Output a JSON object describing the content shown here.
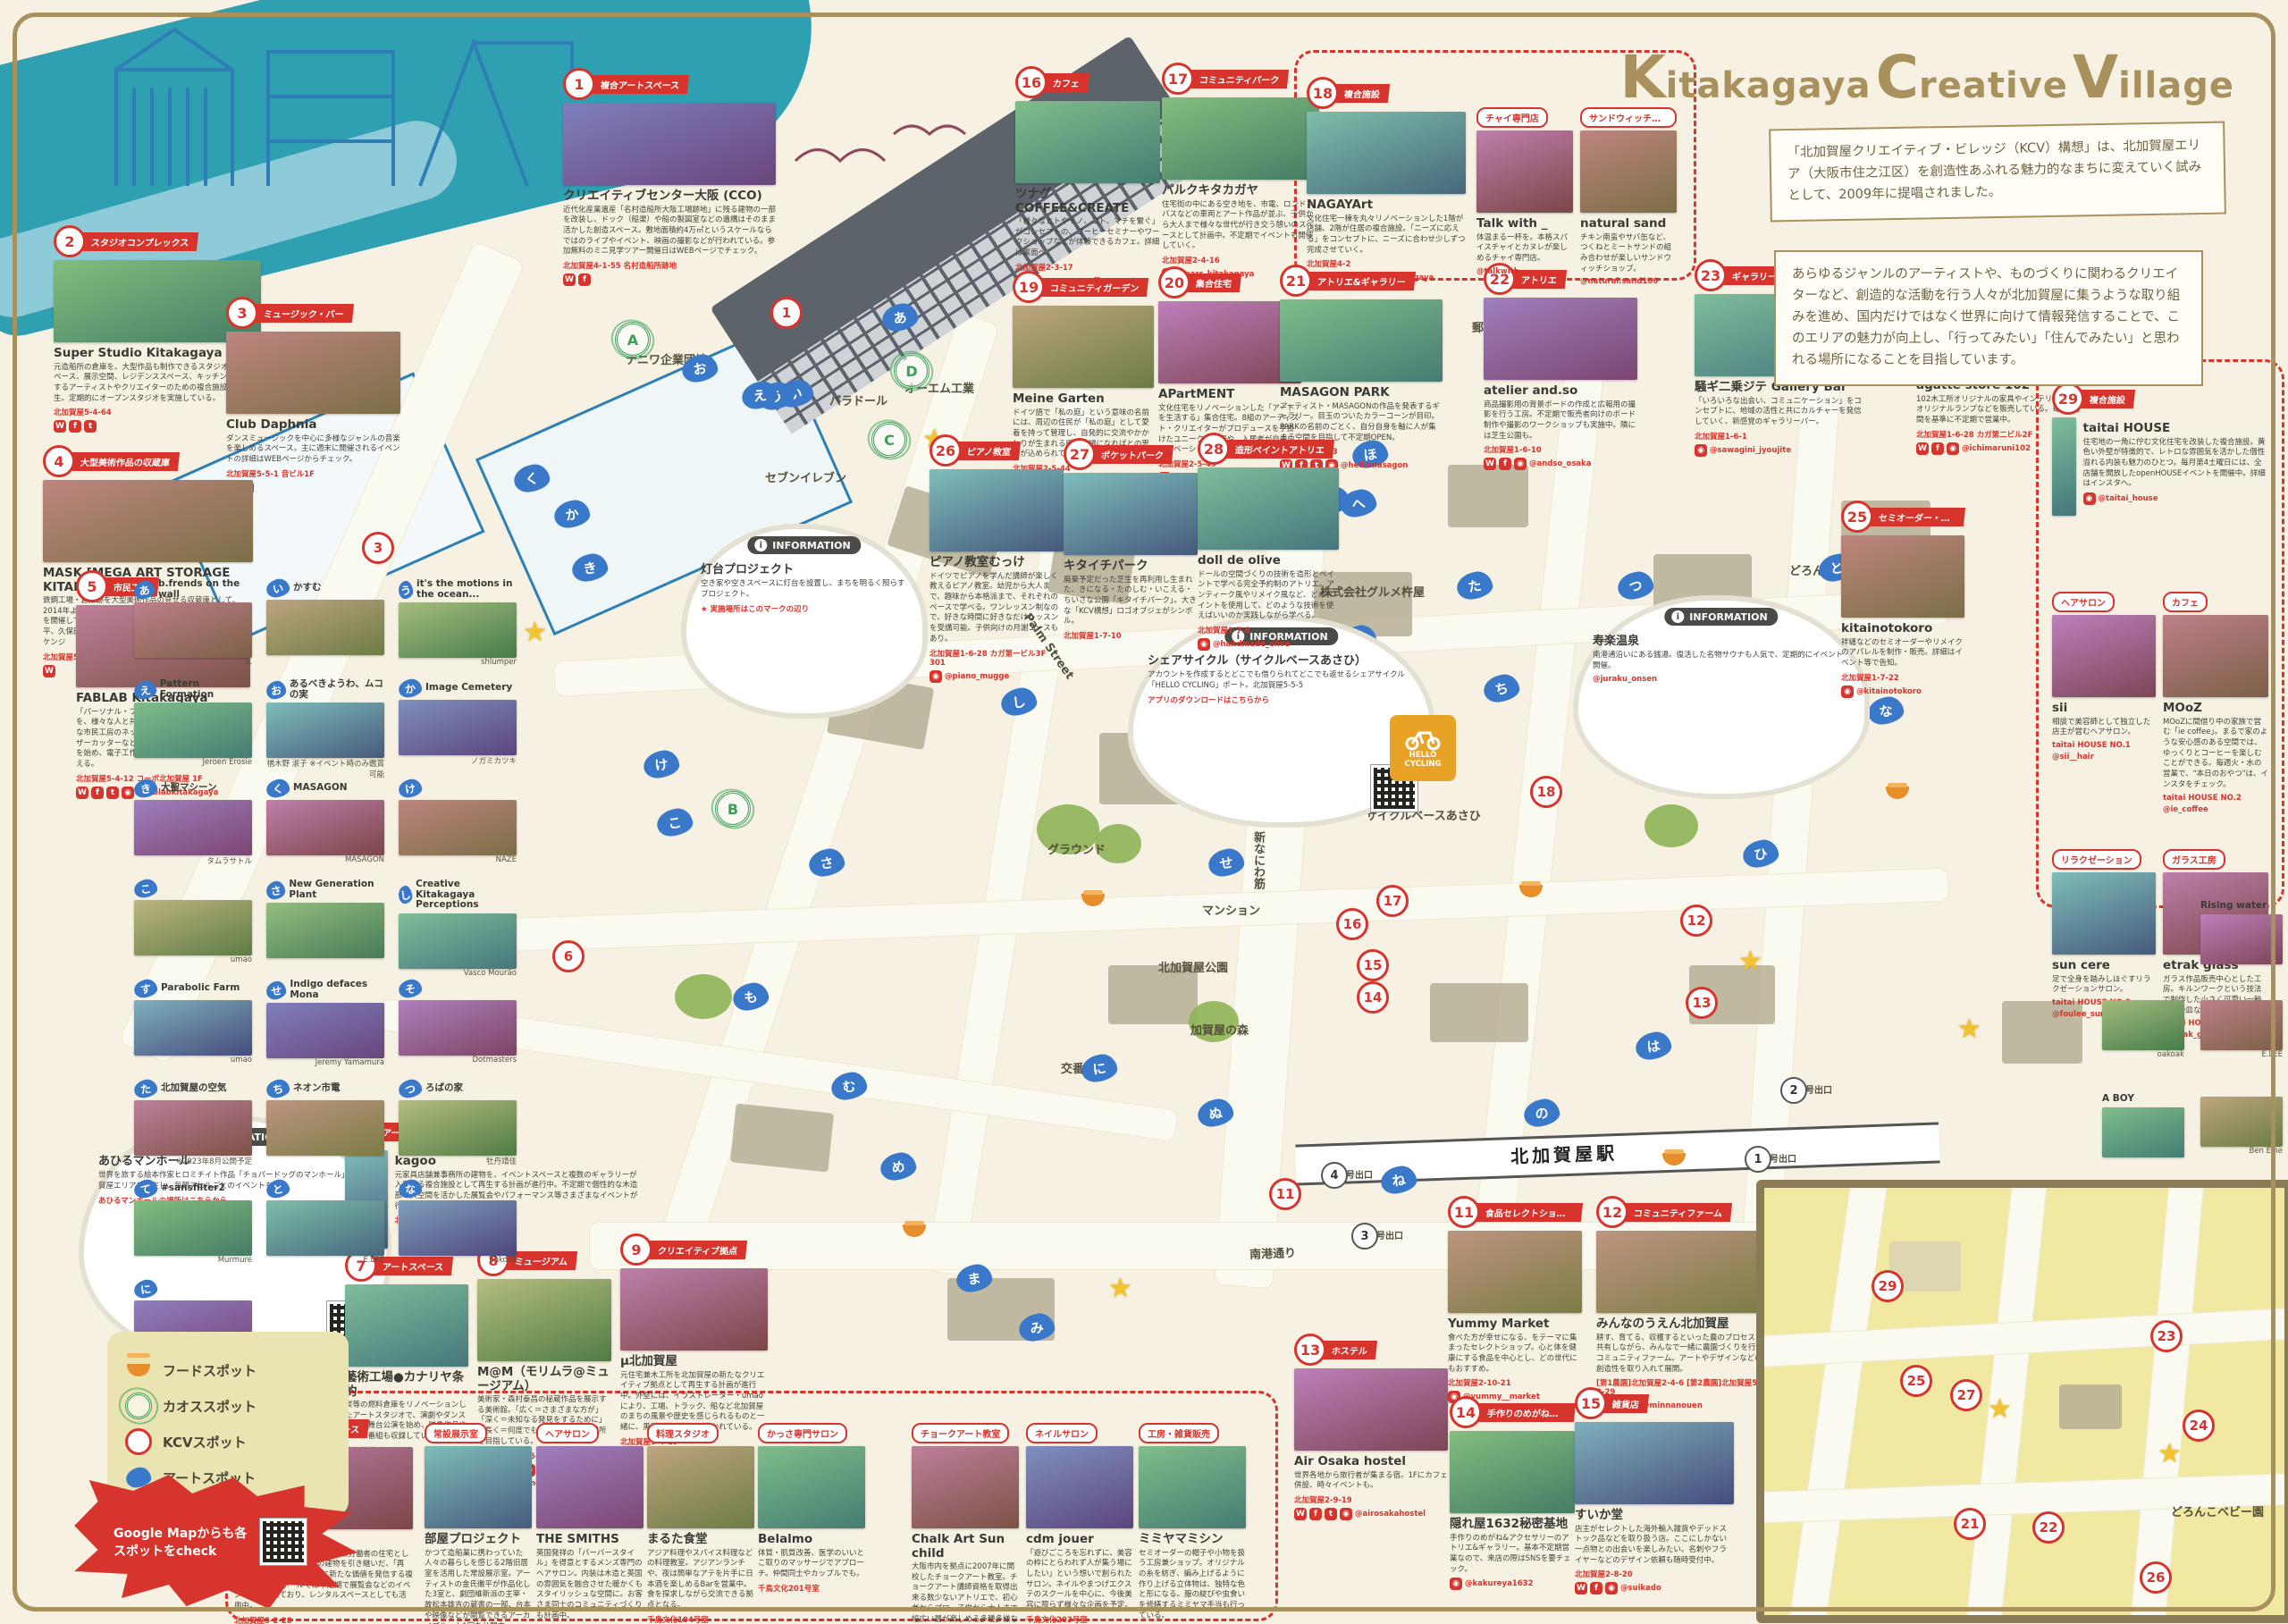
{
  "brand": {
    "line": "Kitakagaya Creative Village",
    "k": "K",
    "itakagaya": "itakagaya",
    "c": "C",
    "reative": "reative",
    "v": "V",
    "illage": "illage"
  },
  "intro": {
    "box1": "「北加賀屋クリエイティブ・ビレッジ（KCV）構想」は、北加賀屋エリア（大阪市住之江区）を創造性あふれる魅力的なまちに変えていく試みとして、2009年に提唱されました。",
    "box2": "あらゆるジャンルのアーティストや、ものづくりに関わるクリエイターなど、創造的な活動を行う人々が北加賀屋に集うような取り組みを進め、国内だけではなく世界に向けて情報発信することで、このエリアの魅力が向上し、「行ってみたい」「住んでみたい」と思われる場所になることを目指しています。"
  },
  "legend": {
    "items": [
      {
        "icon": "food-bowl-icon",
        "label": "フードスポット"
      },
      {
        "icon": "chaos-spot-icon",
        "label": "カオススポット"
      },
      {
        "icon": "kcv-spot-icon",
        "label": "KCVスポット"
      },
      {
        "icon": "art-spot-icon",
        "label": "アートスポット"
      }
    ]
  },
  "google_map_note": "Google Mapからも各スポットをcheck",
  "info_header": "INFORMATION",
  "hello_cycling": "HELLO CYCLING",
  "station": "北加賀屋駅",
  "pois": [
    {
      "num": 1,
      "cat": "複合アートスペース",
      "name": "クリエイティブセンター大阪 (CCO)",
      "desc": "近代化産業遺産「名村造船所大阪工場跡地」に残る建物の一部を改装し、ドック（船渠）や船の製図室などの遺構はそのまま活かした創造スペース。敷地面積約4万㎡というスケールならではのライブやイベント、映画の撮影などが行われている。参加無料のミニ見学ツアー開催日はWEBページでチェック。",
      "addr": "北加賀屋4-1-55 名村造船所跡地",
      "handle": "",
      "sns": [
        "W",
        "f"
      ]
    },
    {
      "num": 2,
      "cat": "スタジオコンプレックス",
      "name": "Super Studio Kitakagaya",
      "desc": "元造船所の倉庫を、大型作品も制作できるスタジオ、ラボスペース、展示空間、レジデンススペース、キッチンなどを有するアーティストやクリエイターのための複合施設として再生。定期的にオープンスタジオを実施している。",
      "addr": "北加賀屋5-4-64",
      "handle": "",
      "sns": [
        "W",
        "f",
        "t"
      ]
    },
    {
      "num": 3,
      "cat": "ミュージック・バー",
      "name": "Club Daphnia",
      "desc": "ダンスミュージックを中心に多様なジャンルの音楽を楽しめるスペース。主に週末に開催されるイベントの詳細はWEBページからチェック。",
      "addr": "北加賀屋5-5-1 音ビル1F",
      "handle": "",
      "sns": [
        "W",
        "t"
      ]
    },
    {
      "num": 4,
      "cat": "大型美術作品の収蔵庫",
      "name": "MASK [MEGA ART STORAGE KITAKAGAYA]",
      "desc": "鉄鋼工場・倉庫跡を大型美術作品の見せる収蔵庫として、2014年より年に1回、一般公開する展覧会「Open Storage」を開催している。参加作家（五十音順）：宇治野宗輝、金氏徹平、久保田弘成、名和晃平、持田敦子、やなぎみわ、ヤノベケンジ",
      "addr": "北加賀屋5-4-48",
      "handle": "",
      "sns": [
        "W"
      ]
    },
    {
      "num": 5,
      "cat": "市民工房",
      "name": "FABLAB Kitakagaya",
      "desc": "「パーソナル・ファブリケーション」の可能性を、様々な人と共同で開拓していくための実験的な市民工房のネットワーク。3Dプリンターやレーザーカッターなどのデジタルファブリケーションを始め、電子工作用機材、木工用の工作機械を備える。",
      "addr": "北加賀屋5-4-12 コーポ北加賀屋 1F",
      "handle": "@fablabkitakagaya",
      "sns": [
        "W",
        "f",
        "t",
        "o"
      ]
    },
    {
      "num": 6,
      "cat": "アートスペース",
      "name": "kagoo",
      "desc": "元家具店舗兼事務所の建物を、イベントスペースと複数のギャラリーが入居する複合施設として再生する計画が進行中。不定期で個性的な木造部の大空間を活かした展覧会やパフォーマンス等さまざまなイベントが行われている。",
      "addr": "北加賀屋5-4-19",
      "handle": "",
      "sns": []
    },
    {
      "num": 7,
      "cat": "アートスペース",
      "name": "藝術工場●カナリヤ条約",
      "desc": "炭等の燃料倉庫をリノベーションしたアートスタジオで、演劇やダンスなどの舞台公演を始め、映像作品やテレビ番組も収録している。",
      "addr": "北加賀屋5-5-35",
      "handle": "",
      "sns": [
        "W",
        "t"
      ]
    },
    {
      "num": 8,
      "cat": "ミュージアム",
      "name": "M@M（モリムラ@ミュージアム）",
      "desc": "美術家・森村泰昌の秘蔵作品を展示する美術館。「広く＝さまざまな方が」「深く＝未知なる発見をするために」「長く＝何度でも訪れたくなる」場所を目指している。",
      "addr": "北加賀屋5-5-36-2F",
      "handle": "@yasumasamorimura",
      "sns": [
        "W",
        "f",
        "t",
        "o"
      ]
    },
    {
      "num": 9,
      "cat": "クリエイティブ拠点",
      "name": "μ北加賀屋",
      "desc": "元住宅兼木工所を北加賀屋の新たなクリエイティブ拠点として再生する計画が進行中。外壁には、イラストレーター・umaoにより、工場、トラック、船など北加賀屋のまちの風景や歴史を感じられるものと一緒に、黒猫が遊ぶ様子が描かれている。",
      "addr": "北加賀屋5-4-19",
      "handle": "",
      "sns": []
    },
    {
      "num": 10,
      "cat": "コミュニティスペース",
      "name": "千鳥文化",
      "desc": "造船業が盛んだった頃に、店舗兼労働者の住宅として使われていた文化住宅の建物を引き継いだ、「再生」「循環」をキーワードに新たな価値を発信する複合施設。1Fのホールでは不定期で展覧会などのイベントが行われており、レンタルスペースとしても活用中。",
      "addr": "北加賀屋5-2-28",
      "handle": "@chidoribunka",
      "sns": [
        "W",
        "f",
        "o"
      ]
    },
    {
      "num": 11,
      "cat": "食品セレクトショップ",
      "name": "Yummy Market",
      "desc": "食べた方が幸せになる、をテーマに集まったセレクトショップ。心と体を健康にする食品を中心とし、どの世代にもおすすめ。",
      "addr": "北加賀屋2-10-21",
      "handle": "@yummy__market",
      "sns": [
        "o"
      ]
    },
    {
      "num": 12,
      "cat": "コミュニティファーム",
      "name": "みんなのうえん北加賀屋",
      "desc": "耕す、育てる、収穫するといった農のプロセスを共有しながら、みんなで一緒に農園づくりを行うコミュニティファーム。アートやデザインなどの創造性を取り入れて展開。",
      "addr": "[第1農園]北加賀屋2-4-6 [第2農園]北加賀屋5-2-29",
      "handle": "@minnanouen",
      "sns": [
        "W",
        "f",
        "o"
      ]
    },
    {
      "num": 13,
      "cat": "ホステル",
      "name": "Air Osaka hostel",
      "desc": "世界各地から旅行者が集まる宿。1Fにカフェ併設、時々イベントも。",
      "addr": "北加賀屋2-9-19",
      "handle": "@airosakahostel",
      "sns": [
        "W",
        "f",
        "t",
        "o"
      ]
    },
    {
      "num": 14,
      "cat": "手作りのめがね&アクセサリー",
      "name": "隠れ屋1632秘密基地",
      "desc": "手作りのめがね&アクセサリーのアトリエ&ギャラリー。基本不定期営業なので、来店の際はSNSを要チェック。",
      "addr": "",
      "handle": "@kakureya1632",
      "sns": [
        "o"
      ]
    },
    {
      "num": 15,
      "cat": "雑貨店",
      "name": "すいか堂",
      "desc": "店主がセレクトした海外輸入雑貨やデッドストック品などを取り扱う店。ここにしかない一点物との出会いを楽しみたい。名刺やフライヤーなどのデザイン依頼も随時受付中。",
      "addr": "北加賀屋2-8-20",
      "handle": "@suikado",
      "sns": [
        "W",
        "f",
        "o"
      ]
    },
    {
      "num": 16,
      "cat": "カフェ",
      "name": "ツナグ COFFEE&CREATE",
      "desc": "「様々なヒトやモノ、コト、マチを繋ぐ」がコンセプトの、コーヒーセミナーやワークショップなどが体験できるカフェ。詳細は裏面へ。",
      "addr": "北加賀屋2-3-17",
      "handle": "@tsu_na_gu.coffee_create",
      "sns": [
        "o"
      ]
    },
    {
      "num": 17,
      "cat": "コミュニティパーク",
      "name": "パルクキタカガヤ",
      "desc": "住宅街の中にある空き地を、市電、ロンドンバスなどの車両とアート作品が並ぶ、子供から大人まで様々な世代が行き交う憩いのスペースとして計画中。不定期でイベントも開催していく。",
      "addr": "北加賀屋2-4-16",
      "handle": "@parc_kitakagaya",
      "sns": [
        "o"
      ]
    },
    {
      "num": 18,
      "cat": "複合施設",
      "name": "NAGAYArt",
      "desc": "文化住宅一棟を丸々リノベーションした1階が店舗、2階が住居の複合施設。「ニーズに応える」をコンセプトに、ニーズに合わせ少しずつ完成させていく。",
      "addr": "北加賀屋4-2",
      "handle": "@nagayart_kitakagaya",
      "sns": [
        "f",
        "o"
      ]
    },
    {
      "num": 19,
      "cat": "コミュニティガーデン",
      "name": "Meine Garten",
      "desc": "ドイツ語で「私の庭」という意味の名前には、周辺の住民が「私の庭」として愛着を持って管理し、自発的に交流やかかわりが生まれる暖かい場になればとの思いが込められている。",
      "addr": "北加賀屋2-5-44",
      "handle": "",
      "sns": []
    },
    {
      "num": 20,
      "cat": "集合住宅",
      "name": "APartMENT",
      "desc": "文化住宅をリノベーションした「アートを生活する」集合住宅。8組のアーティスト・クリエイターがプロデュースを手掛けたユニークな部屋や、入居者が自由にリノベーションできる部屋がある。",
      "addr": "北加賀屋2-5-45",
      "handle": "",
      "sns": [
        "W"
      ]
    },
    {
      "num": 21,
      "cat": "アトリエ&ギャラリー",
      "name": "MASAGON PARK",
      "desc": "アーティスト・MASAGONの作品を発表するギャラリー。目玉のついたカラーコーンが目印。PARKの名前のごとく、自分自身を軸に人が集まる空間を目指して不定期OPEN。",
      "addr": "北加賀屋1-6-23",
      "handle": "@hellomasagon",
      "sns": [
        "W",
        "f",
        "t",
        "o"
      ]
    },
    {
      "num": 22,
      "cat": "アトリエ",
      "name": "atelier and.so",
      "desc": "商品撮影用の背景ボードの作成と広報用の撮影を行う工房。不定期で販売者向けのボード制作や撮影のワークショップも実施中。隣には芝生公園も。",
      "addr": "北加賀屋1-6-10",
      "handle": "@andso_osaka",
      "sns": [
        "W",
        "f",
        "o"
      ]
    },
    {
      "num": 23,
      "cat": "ギャラリー・バー",
      "name": "騒ギ二乗ジテ Gallery Bar",
      "desc": "「いろいろな出会い、コミュニケーション」をコンセプトに、地域の活性と共にカルチャーを発信していく、新感覚のギャラリーバー。",
      "addr": "北加賀屋1-6-1",
      "handle": "@sawagini_jyoujite",
      "sns": [
        "o"
      ]
    },
    {
      "num": 24,
      "cat": "オリジナル家具・雑貨ショップ",
      "name": "agatte store 102",
      "desc": "102木工所オリジナルの家具やインテリア小物、オリジナルランプなどを販売している。毎月1週間を基準に不定期で営業中。",
      "addr": "北加賀屋1-6-28 カガ第二ビル2F",
      "handle": "@ichimaruni102",
      "sns": [
        "W",
        "f",
        "o"
      ]
    },
    {
      "num": 25,
      "cat": "セミオーダー・リメイク・アパレル",
      "name": "kitainotokoro",
      "desc": "袢纏などのセミオーダーやリメイクのアパレルを制作・販売。詳細はイベント等で告知。",
      "addr": "北加賀屋1-7-22",
      "handle": "@kitainotokoro",
      "sns": [
        "o"
      ]
    },
    {
      "num": 26,
      "cat": "ピアノ教室",
      "name": "ピアノ教室むっけ",
      "desc": "ドイツでピアノを学んだ講師が楽しく教えるピアノ教室。幼児から大人まで、趣味から本格派まで、それぞれのペースで学べる。ワンレッスン制なので、好きな時間に好きなだけレッスンを受講可能。子供向けの月謝コースもあり。",
      "addr": "北加賀屋1-6-28 カガ第一ビル3F 301",
      "handle": "@piano_mugge",
      "sns": [
        "o"
      ]
    },
    {
      "num": 27,
      "cat": "ポケットパーク",
      "name": "キタイチパーク",
      "desc": "廃棄予定だった芝生を再利用し生まれた、きになる・たのしむ・いこえる・ちいさな公園「キタイチパーク」。大きな「KCV構想」ロゴオブジェがシンボル。",
      "addr": "北加賀屋1-7-10",
      "handle": "",
      "sns": []
    },
    {
      "num": 28,
      "cat": "造形ペイントアトリエ",
      "name": "doll de olive",
      "desc": "ドールの空間づくりの技術を造形とペイントで学べる完全予約制のアトリエ。アンティーク風やリメイク風など、どのペイントを使用して、どのような技術を使えばいいのか実践しながら学べる。",
      "addr": "北加賀屋1-7-8",
      "handle": "@handmade_olive",
      "sns": [
        "o"
      ]
    },
    {
      "num": 29,
      "cat": "複合施設",
      "name": "taitai HOUSE",
      "desc": "住宅地の一角に佇む文化住宅を改装した複合施設。黄色い外壁が特徴的で、レトロな雰囲気を活かした個性溢れる内装も魅力のひとつ。毎月第4土曜日には、全店舗を開放したopenHOUSEイベントを開催中。詳細はインスタへ。",
      "addr": "",
      "handle": "@taitai_house",
      "sns": [
        "o"
      ]
    }
  ],
  "nagayart_tenants": [
    {
      "cat": "チャイ専門店",
      "name": "Talk with _",
      "desc": "体温まる一杯を。本格スパイスチャイとカヌレが楽しめるチャイ専門店。",
      "addr": "",
      "handle": "@talkwith__"
    },
    {
      "cat": "サンドウィッチ専門店",
      "name": "natural sand",
      "desc": "チキン南蛮やサバ缶など、つくねとミートサンドの組み合わせが楽しいサンドウィッチショップ。",
      "addr": "",
      "handle": "@natural.sand106"
    }
  ],
  "taitai_tenants": [
    {
      "cat": "ヘアサロン",
      "name": "sii",
      "desc": "相談で美容師として独立した店主が営むヘアサロン。",
      "addr": "taitai HOUSE NO.1",
      "handle": "@sii__hair"
    },
    {
      "cat": "カフェ",
      "name": "MOoZ",
      "desc": "MOoZに間借り中の家族で営む「ie coffee」。まるで家のような安心感のある空間では、ゆっくりとコーヒーを楽しむことができる。毎週火・水の営業で、\"本日のおやつ\"は、インスタをチェック。",
      "addr": "taitai HOUSE NO.2",
      "handle": "@ie_coffee"
    },
    {
      "cat": "リラクゼーション",
      "name": "sun cere",
      "desc": "足で全身を踏みしほぐすリラクゼーションサロン。",
      "addr": "taitai HOUSE NO.3",
      "handle": "@foulee_suncere"
    },
    {
      "cat": "ガラス工房",
      "name": "etrak glass",
      "desc": "ガラス作品販売中心とした工房。キルンワークという技法で制作した小さく可愛い一輪挿しや皿など。",
      "addr": "taitai HOUSE NO.4",
      "handle": "@etrak_glass"
    }
  ],
  "chidori_tenants": [
    {
      "cat": "常設展示室",
      "name": "部屋プロジェクト",
      "desc": "かつて造船業に携わっていた人々の暮らしを感じる2階旧居室を活用した常設展示室。アーティストの金氏徹平が作品化した3室と、劇団維新派の主宰・故松本雄吉の蔵書の一部、台本や映像などが閲覧できるアーカイブルーム1室を公開中。",
      "addr": "千鳥文化2F",
      "handle": ""
    },
    {
      "cat": "ヘアサロン",
      "name": "THE SMITHS",
      "desc": "英国発祥の「バーバースタイル」を得意とするメンズ専門のヘアサロン。内装は木造と英国の雰囲気を融合させた暖かくもスタイリッシュな空間に。お客さま同士のコミュニティづくりも計画中。",
      "addr": "千鳥文化103号室",
      "handle": "@thesmiths_barber"
    },
    {
      "cat": "料理スタジオ",
      "name": "まるた食堂",
      "desc": "アジア料理やスパイス料理などの料理教室。アジアンランチや、夜は簡単なアテを片手に日本酒を楽しめるBarを営業中。食を探求しながら交流できる拠点となる。",
      "addr": "千鳥文化104号室",
      "handle": "@maruta_shokudo"
    },
    {
      "cat": "かっさ専門サロン",
      "name": "Belalmo",
      "desc": "体質・肌質改善、医学のいいとこ取りのマッサージでアプローチ。仲間同士やカップルでも。",
      "addr": "千鳥文化201号室",
      "handle": ""
    },
    {
      "cat": "チョークアート教室",
      "name": "Chalk Art Sun child",
      "desc": "大阪市内を拠点に2007年に開校したチョークアート教室。チョークアート講師資格を取得出来る数少ないアトリエで、初心者からプロ、子供から大人まで幅広い層が楽しめる多種多様なコースとレッスンが用意されている。",
      "addr": "千鳥文化202号室",
      "handle": "@chalkartsunchild"
    },
    {
      "cat": "ネイルサロン",
      "name": "cdm jouer",
      "desc": "「遊びごころを忘れずに、美容の枠にとらわれず人が集う場にしたい」という想いで創られたサロン。ネイルやまつげエクステのスクールを中心に、今後美容に限らず様々な企画を予定。",
      "addr": "千鳥文化203号室",
      "handle": "@nailschool.cdm"
    },
    {
      "cat": "工房・雑貨販売",
      "name": "ミミヤマミシン",
      "desc": "セミオーダーの帽子や小物を扱う工房兼ショップ。オリジナルの糸を紡ぎ、編み上げるように作り上げる立体物は、独特な色と形になる。服の綻びや虫食いを修繕するミミヤマ手当も行っている。",
      "addr": "千鳥文化205号室",
      "handle": "@soda_tomoko"
    }
  ],
  "art_spots": [
    {
      "kana": "あ",
      "name": "b.frends on the wall",
      "artist": "b."
    },
    {
      "kana": "い",
      "name": "かすむ",
      "artist": ""
    },
    {
      "kana": "う",
      "name": "it's the motions in the ocean...",
      "artist": "shlumper"
    },
    {
      "kana": "え",
      "name": "Pattern Formation",
      "artist": "Jeroen Erosie"
    },
    {
      "kana": "お",
      "name": "あるべきようわ、ムコの実",
      "artist": "楢木野 淑子 ※イベント時のみ鑑賞可能"
    },
    {
      "kana": "か",
      "name": "Image Cemetery",
      "artist": "ノガミカツキ"
    },
    {
      "kana": "き",
      "name": "大聖マシーン",
      "artist": "タムラサトル"
    },
    {
      "kana": "く",
      "name": "MASAGON",
      "artist": "MASAGON"
    },
    {
      "kana": "け",
      "name": "",
      "artist": "NAZE"
    },
    {
      "kana": "こ",
      "name": "",
      "artist": "umao"
    },
    {
      "kana": "さ",
      "name": "New Generation Plant",
      "artist": ""
    },
    {
      "kana": "し",
      "name": "Creative Kitakagaya Perceptions",
      "artist": "Vasco Mourão"
    },
    {
      "kana": "す",
      "name": "Parabolic Farm",
      "artist": "umao"
    },
    {
      "kana": "せ",
      "name": "Indigo defaces Mona",
      "artist": "Jeremy Yamamura"
    },
    {
      "kana": "そ",
      "name": "",
      "artist": "Dotmasters"
    },
    {
      "kana": "た",
      "name": "北加賀屋の空気",
      "artist": "※2023年8月公開予定"
    },
    {
      "kana": "ち",
      "name": "ネオン市電",
      "artist": ""
    },
    {
      "kana": "つ",
      "name": "ろばの家",
      "artist": "牡丹靖佳"
    },
    {
      "kana": "て",
      "name": "#sansfilter2",
      "artist": "Murmure"
    },
    {
      "kana": "と",
      "name": "",
      "artist": "E.LEE"
    },
    {
      "kana": "な",
      "name": "",
      "artist": "oakoak"
    },
    {
      "kana": "に",
      "name": "",
      "artist": "Ben Eine"
    }
  ],
  "right_art": [
    {
      "name": "Rising water",
      "artist": ""
    },
    {
      "name": "",
      "artist": "E.LEE"
    },
    {
      "name": "",
      "artist": "Ben Eine"
    },
    {
      "name": "",
      "artist": "oakoak"
    },
    {
      "name": "A BOY",
      "artist": ""
    },
    {
      "name": "",
      "artist": "borutanext5"
    }
  ],
  "info_boxes": [
    {
      "id": "lighthouse",
      "title": "灯台プロジェクト",
      "body": "空き家や空きスペースに灯台を設置し、まちを明るく照らすプロジェクト。",
      "cta": "★ 実施場所はこのマークの辺り",
      "qr": false
    },
    {
      "id": "cycle",
      "title": "シェアサイクル（サイクルベースあさひ）",
      "body": "アカウントを作成するとどこでも借りられてどこでも返せるシェアサイクル「HELLO CYCLING」ポート。北加賀屋5-5-5",
      "cta": "アプリのダウンロードはこちらから",
      "qr": true
    },
    {
      "id": "onsen",
      "title": "寿楽温泉",
      "body": "南港通沿いにある銭湯。復活した名物サウナも人気で、定期的にイベント開催。",
      "cta": "@juraku_onsen",
      "qr": false
    },
    {
      "id": "manhole",
      "title": "あひるマンホール",
      "body": "世界を旅する絵本作家ヒロミチイト作品「チョパードッグのマンホール」。北加賀屋エリアに点在し、毎朝アヒルごとのイベントも。",
      "cta": "あひるマンホールの場所はこちらから",
      "qr": true
    }
  ],
  "map_labels": [
    "ナニワ企業団地",
    "オーエム工業",
    "パラドール",
    "セブンイレブン",
    "グラウンド",
    "マンション",
    "北加賀屋公園",
    "加賀屋の森",
    "新なにわ筋",
    "Palm Street",
    "南港通り",
    "株式会社グルメ杵屋",
    "ローソン",
    "郵便局",
    "交番",
    "どろんこ保育園",
    "サイクルベースあさひ",
    "千鳥公園"
  ],
  "exits": [
    {
      "n": "1",
      "label": "号出口"
    },
    {
      "n": "2",
      "label": "号出口"
    },
    {
      "n": "3",
      "label": "号出口"
    },
    {
      "n": "4",
      "label": "号出口"
    }
  ],
  "chaos_spots": [
    "A",
    "B",
    "C",
    "D",
    "E"
  ],
  "kana_markers": [
    "あ",
    "い",
    "う",
    "え",
    "お",
    "か",
    "き",
    "く",
    "け",
    "こ",
    "さ",
    "し",
    "す",
    "せ",
    "そ",
    "た",
    "ち",
    "つ",
    "て",
    "と",
    "な",
    "に",
    "ぬ",
    "ね",
    "の",
    "は",
    "ひ",
    "ふ",
    "へ",
    "ほ",
    "ま",
    "み",
    "む",
    "め",
    "も"
  ],
  "inset": {
    "label": "どろんこベビー園",
    "markers": [
      29,
      25,
      27,
      21,
      22,
      23,
      24,
      26
    ]
  }
}
